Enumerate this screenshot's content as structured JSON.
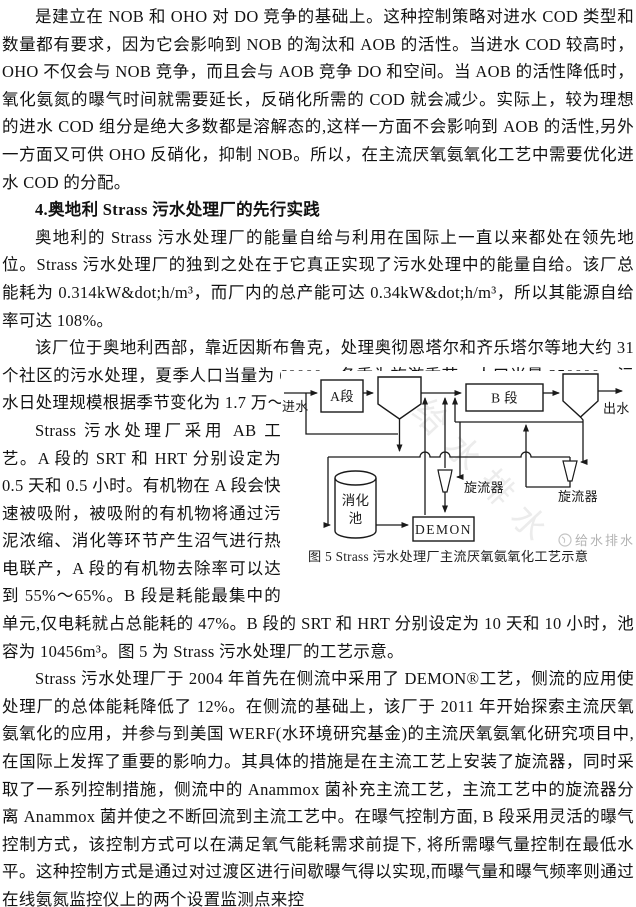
{
  "document": {
    "heading": "4.奥地利 Strass 污水处理厂的先行实践",
    "paragraphs": [
      "是建立在 NOB 和 OHO 对 DO 竞争的基础上。这种控制策略对进水 COD 类型和数量都有要求，因为它会影响到 NOB 的淘汰和 AOB 的活性。当进水 COD 较高时，OHO 不仅会与 NOB 竞争，而且会与 AOB 竞争 DO 和空间。当 AOB 的活性降低时，氧化氨氮的曝气时间就需要延长，反硝化所需的 COD 就会减少。实际上，较为理想的进水 COD 组分是绝大多数都是溶解态的,这样一方面不会影响到 AOB 的活性,另外一方面又可供 OHO 反硝化，抑制 NOB。所以，在主流厌氧氨氧化工艺中需要优化进水 COD 的分配。",
      "奥地利的 Strass 污水处理厂的能量自给与利用在国际上一直以来都处在领先地位。Strass 污水处理厂的独到之处在于它真正实现了污水处理中的能量自给。该厂总能耗为 0.314kW&dot;h/m³，而厂内的总产能可达 0.34kW&dot;h/m³，所以其能源自给率可达 108%。",
      "该厂位于奥地利西部，靠近因斯布鲁克，处理奥彻恩塔尔和齐乐塔尔等地大约 31 个社区的污水处理，夏季人口当量为 60000，冬季为旅游季节，人口当量 250000。污水日处理规模根据季节变化为 1.7 万～3.8 万 m³,平均日处理量为 2.65 万 m³。",
      "Strass 污水处理厂采用 AB 工艺。A 段的 SRT 和 HRT 分别设定为 0.5 天和 0.5 小时。有机物在 A 段会快速被吸附，被吸附的有机物将通过污泥浓缩、消化等环节产生沼气进行热电联产，A 段的有机物去除率可以达到 55%～65%。B 段是耗能最集中的单元,仅电耗就占总能耗的 47%。B 段的 SRT 和 HRT 分别设定为 10 天和 10 小时，池容为 10456m³。图 5 为 Strass 污水处理厂的工艺示意。",
      "Strass 污水处理厂于 2004 年首先在侧流中采用了 DEMON®工艺，侧流的应用使处理厂的总体能耗降低了 12%。在侧流的基础上，该厂于 2011 年开始探索主流厌氧氨氧化的应用，并参与到美国 WERF(水环境研究基金)的主流厌氧氨氧化研究项目中,在国际上发挥了重要的影响力。其具体的措施是在主流工艺上安装了旋流器，同时采取了一系列控制措施，侧流中的 Anammox 菌补充主流工艺，主流工艺中的旋流器分离 Anammox 菌并使之不断回流到主流工艺中。在曝气控制方面, B 段采用灵活的曝气控制方式，该控制方式可以在满足氧气能耗需求前提下, 将所需曝气量控制在最低水平。这种控制方式是通过对过渡区进行间歇曝气得以实现,而曝气量和曝气频率则通过在线氨氮监控仪上的两个设置监测点来控"
    ]
  },
  "figure": {
    "caption": "图 5   Strass 污水处理厂主流厌氧氨氧化工艺示意",
    "labels": {
      "influent": "进水",
      "a_stage": "A段",
      "b_stage": "B 段",
      "effluent": "出水",
      "digester_l1": "消化",
      "digester_l2": "池",
      "demon": "DEMON",
      "cyclone_mid": "旋流器",
      "cyclone_right": "旋流器"
    },
    "watermark_diagonal": "给水排水",
    "watermark_corner": "给水排水"
  }
}
